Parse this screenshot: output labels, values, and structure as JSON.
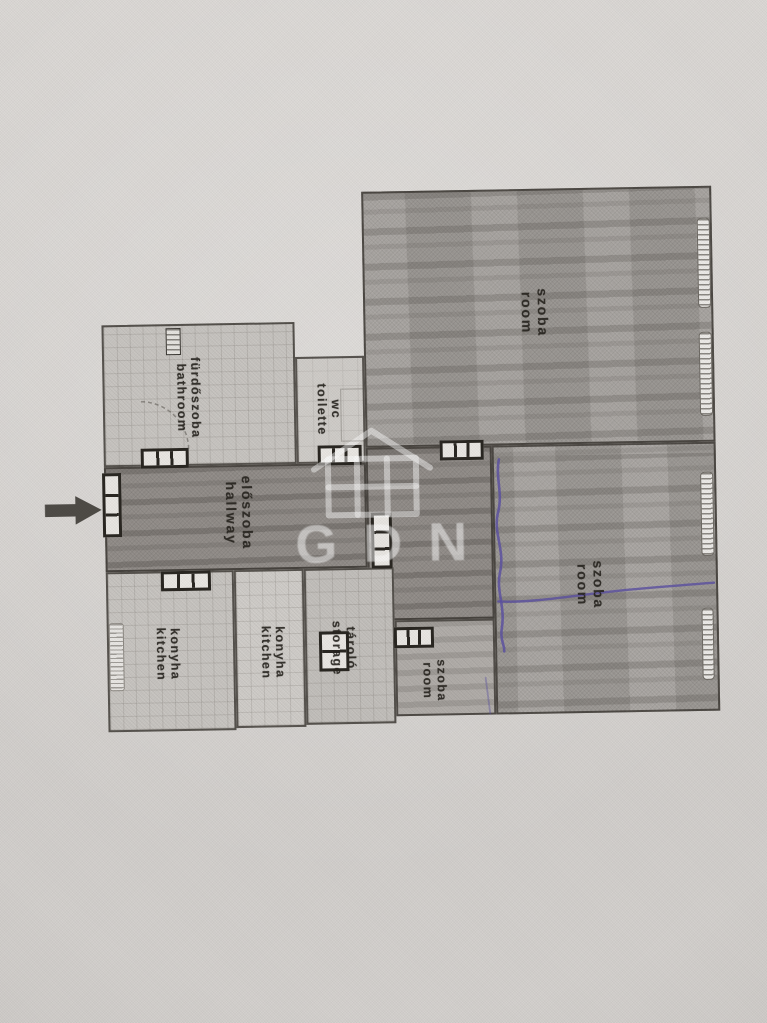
{
  "floorplan": {
    "watermark_text": "GDN",
    "labels": {
      "room_large": {
        "hu": "szoba",
        "en": "room"
      },
      "room_right": {
        "hu": "szoba",
        "en": "room"
      },
      "room_small": {
        "hu": "szoba",
        "en": "room"
      },
      "bathroom": {
        "hu": "fürdőszoba",
        "en": "bathroom"
      },
      "wc": {
        "hu": "wc",
        "en": "toilette"
      },
      "hallway": {
        "hu": "előszoba",
        "en": "hallway"
      },
      "kitchen_left": {
        "hu": "konyha",
        "en": "kitchen"
      },
      "kitchen_mid": {
        "hu": "konyha",
        "en": "kitchen"
      },
      "storage": {
        "hu": "tároló",
        "en": "storage"
      }
    },
    "colors": {
      "paper": "#d8d5d2",
      "room_fill": "#a7a39f",
      "hall_fill": "#96918d",
      "tile_fill": "#cac7c3",
      "wall": "#38342f",
      "ink_annotation": "#5b50a3",
      "watermark": "#ffffff"
    }
  }
}
